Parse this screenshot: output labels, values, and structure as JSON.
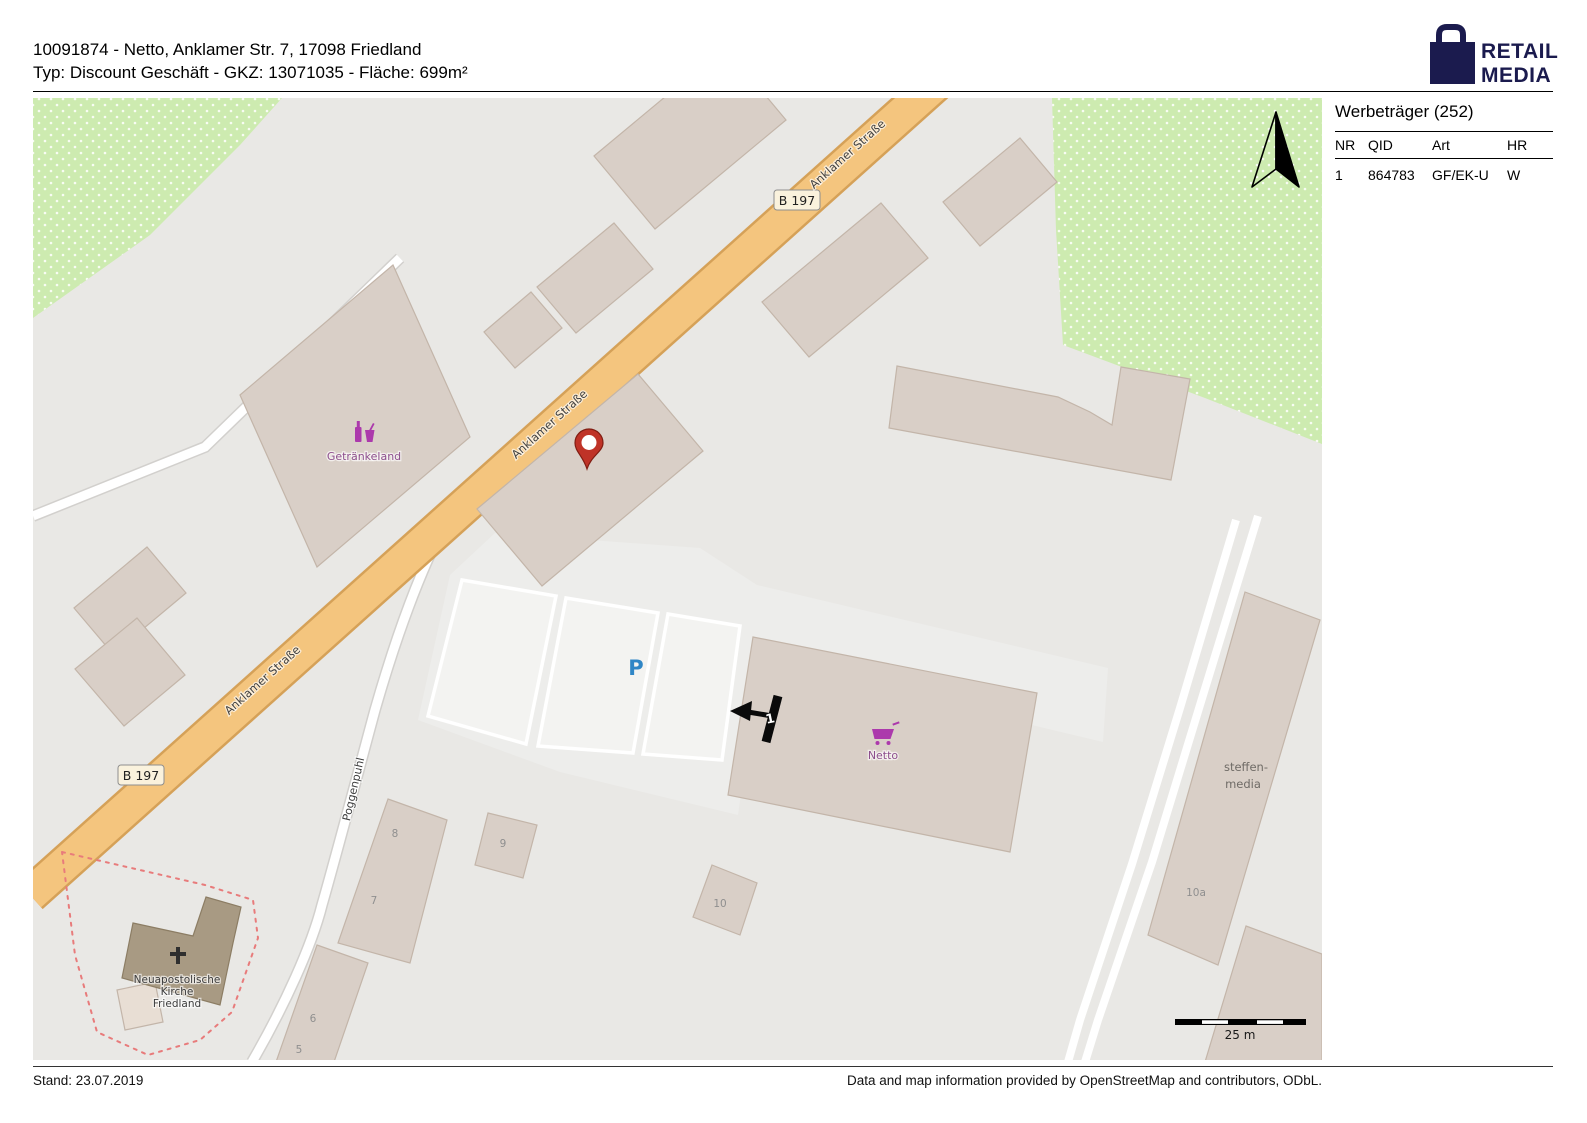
{
  "header": {
    "line1": "10091874 - Netto, Anklamer Str. 7, 17098 Friedland",
    "line2": "Typ: Discount Geschäft - GKZ: 13071035 - Fläche: 699m²"
  },
  "logo": {
    "line1": "RETAIL",
    "line2": "MEDIA"
  },
  "sidebar": {
    "title": "Werbeträger (252)",
    "headers": [
      "NR",
      "QID",
      "Art",
      "HR"
    ],
    "rows": [
      [
        "1",
        "864783",
        "GF/EK-U",
        "W"
      ]
    ]
  },
  "map": {
    "street_name_main": "Anklamer Straße",
    "street_name_side": "Poggenpuhl",
    "route_ref": "B 197",
    "labels": {
      "getraenkeland": "Getränkeland",
      "netto": "Netto",
      "steffen_line1": "steffen-",
      "steffen_line2": "media",
      "church_line1": "Neuapostolische",
      "church_line2": "Kirche",
      "church_line3": "Friedland",
      "parking": "P",
      "marker_number": "1",
      "scale": "25 m",
      "house_numbers": {
        "h5": "5",
        "h6": "6",
        "h7": "7",
        "h8": "8",
        "h9": "9",
        "h10": "10",
        "h10a": "10a"
      }
    }
  },
  "footer": {
    "left": "Stand: 23.07.2019",
    "right": "Data and map information provided by OpenStreetMap and contributors, ODbL."
  },
  "colors": {
    "logo_navy": "#1b1b4e",
    "road_orange": "#f4c57e",
    "road_casing": "#d5a158",
    "green_area": "#cdebb0",
    "building_fill": "#d9cfc7",
    "building_stroke": "#c3b5a9",
    "church_fill": "#a89a83",
    "map_bg": "#e9e8e5",
    "parking_fill": "#ededeb",
    "poi_purple": "#ac39ac",
    "poi_label_purple": "#8d4f8d",
    "parking_blue": "#2f86c6",
    "pin_red": "#bf3327",
    "boundary_red": "#e87b7b"
  }
}
